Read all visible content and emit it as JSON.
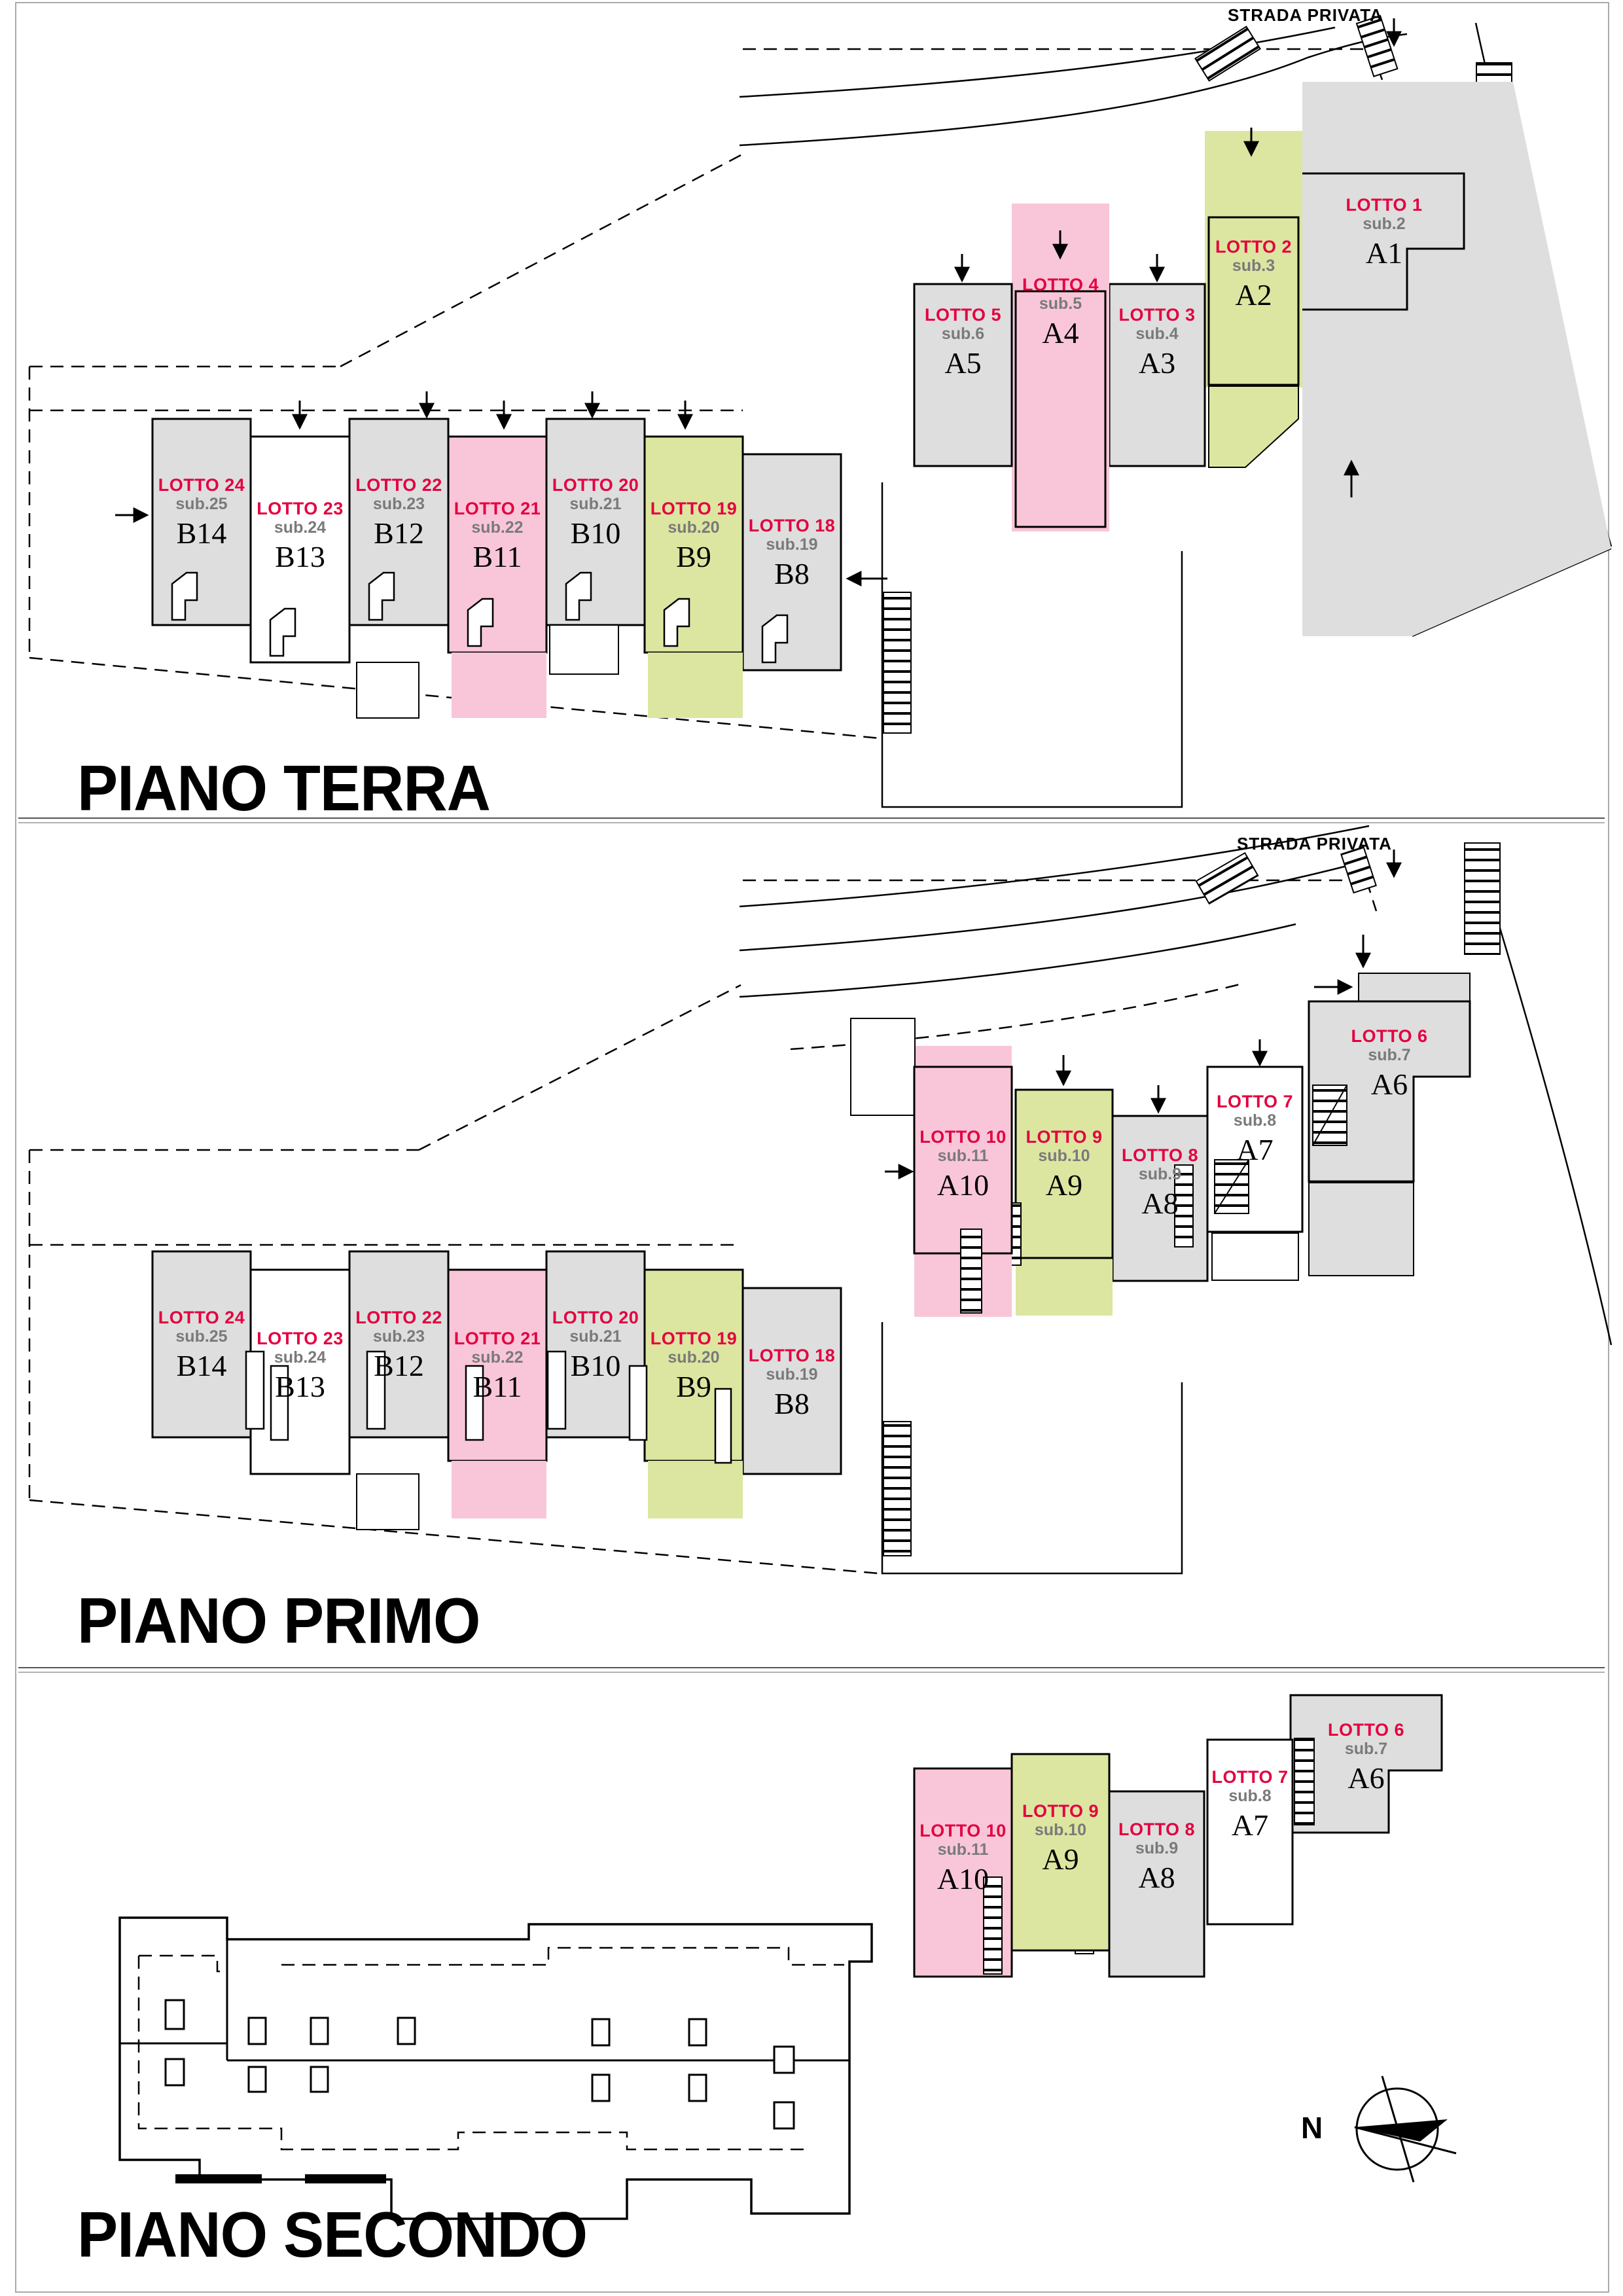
{
  "page": {
    "strada_privata": "STRADA PRIVATA",
    "compass_n": "N"
  },
  "colors": {
    "unit_gray": "#dedede",
    "unit_pink": "#f9c6d9",
    "unit_green": "#dce6a0",
    "unit_white": "#ffffff",
    "lotto_red": "#e3003f",
    "sub_gray": "#7a7a7a"
  },
  "floors": [
    {
      "title": "PIANO TERRA",
      "units": [
        {
          "lotto": "LOTTO 1",
          "sub": "sub.2",
          "code": "A1"
        },
        {
          "lotto": "LOTTO 2",
          "sub": "sub.3",
          "code": "A2"
        },
        {
          "lotto": "LOTTO 3",
          "sub": "sub.4",
          "code": "A3"
        },
        {
          "lotto": "LOTTO 4",
          "sub": "sub.5",
          "code": "A4"
        },
        {
          "lotto": "LOTTO 5",
          "sub": "sub.6",
          "code": "A5"
        },
        {
          "lotto": "LOTTO 24",
          "sub": "sub.25",
          "code": "B14"
        },
        {
          "lotto": "LOTTO 23",
          "sub": "sub.24",
          "code": "B13"
        },
        {
          "lotto": "LOTTO 22",
          "sub": "sub.23",
          "code": "B12"
        },
        {
          "lotto": "LOTTO 21",
          "sub": "sub.22",
          "code": "B11"
        },
        {
          "lotto": "LOTTO 20",
          "sub": "sub.21",
          "code": "B10"
        },
        {
          "lotto": "LOTTO 19",
          "sub": "sub.20",
          "code": "B9"
        },
        {
          "lotto": "LOTTO 18",
          "sub": "sub.19",
          "code": "B8"
        }
      ]
    },
    {
      "title": "PIANO PRIMO",
      "units": [
        {
          "lotto": "LOTTO 6",
          "sub": "sub.7",
          "code": "A6"
        },
        {
          "lotto": "LOTTO 7",
          "sub": "sub.8",
          "code": "A7"
        },
        {
          "lotto": "LOTTO 8",
          "sub": "sub.9",
          "code": "A8"
        },
        {
          "lotto": "LOTTO 9",
          "sub": "sub.10",
          "code": "A9"
        },
        {
          "lotto": "LOTTO 10",
          "sub": "sub.11",
          "code": "A10"
        },
        {
          "lotto": "LOTTO 24",
          "sub": "sub.25",
          "code": "B14"
        },
        {
          "lotto": "LOTTO 23",
          "sub": "sub.24",
          "code": "B13"
        },
        {
          "lotto": "LOTTO 22",
          "sub": "sub.23",
          "code": "B12"
        },
        {
          "lotto": "LOTTO 21",
          "sub": "sub.22",
          "code": "B11"
        },
        {
          "lotto": "LOTTO 20",
          "sub": "sub.21",
          "code": "B10"
        },
        {
          "lotto": "LOTTO 19",
          "sub": "sub.20",
          "code": "B9"
        },
        {
          "lotto": "LOTTO 18",
          "sub": "sub.19",
          "code": "B8"
        }
      ]
    },
    {
      "title": "PIANO SECONDO",
      "units": [
        {
          "lotto": "LOTTO 6",
          "sub": "sub.7",
          "code": "A6"
        },
        {
          "lotto": "LOTTO 7",
          "sub": "sub.8",
          "code": "A7"
        },
        {
          "lotto": "LOTTO 8",
          "sub": "sub.9",
          "code": "A8"
        },
        {
          "lotto": "LOTTO 9",
          "sub": "sub.10",
          "code": "A9"
        },
        {
          "lotto": "LOTTO 10",
          "sub": "sub.11",
          "code": "A10"
        }
      ]
    }
  ]
}
